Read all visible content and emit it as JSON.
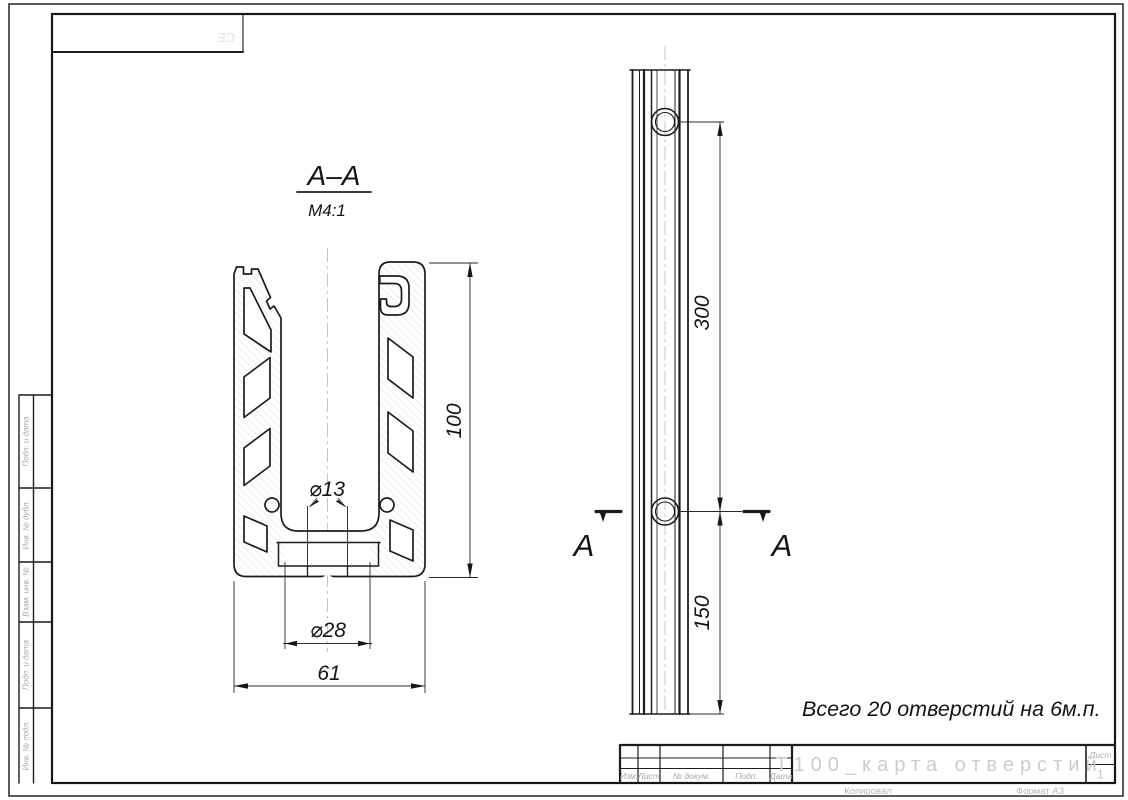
{
  "colors": {
    "line": "#1c1c1c",
    "dim": "#2a2a2a",
    "hatch": "#d4d4d4",
    "centerline": "#c6c6c6",
    "ghost": "#cccccc",
    "label_gray": "#a8a8a8"
  },
  "section_view": {
    "title": "A–A",
    "scale": "M4:1",
    "dim_height": "100",
    "dim_hole": "⌀13",
    "dim_counterbore": "⌀28",
    "dim_width": "61"
  },
  "side_view": {
    "hole_spacing": "300",
    "end_offset": "150",
    "cut_label_left": "A",
    "cut_label_right": "A"
  },
  "note": "Всего 20 отверстий на 6м.п.",
  "title_block": {
    "doc_title": "T100_карта отверстий",
    "sheet_label": "Лист",
    "sheet_number": "1",
    "footer_left": "Копировал",
    "footer_right": "Формат А3",
    "columns": [
      "Изм.",
      "Лист",
      "№ докум.",
      "Подп.",
      "Дата"
    ]
  },
  "frame": {
    "side_labels": [
      "Подп. и дата",
      "Инв. № дубл.",
      "Взам. инв. №",
      "Подп. и дата",
      "Инв. № подл."
    ],
    "corner_stamp": "СЕ"
  }
}
